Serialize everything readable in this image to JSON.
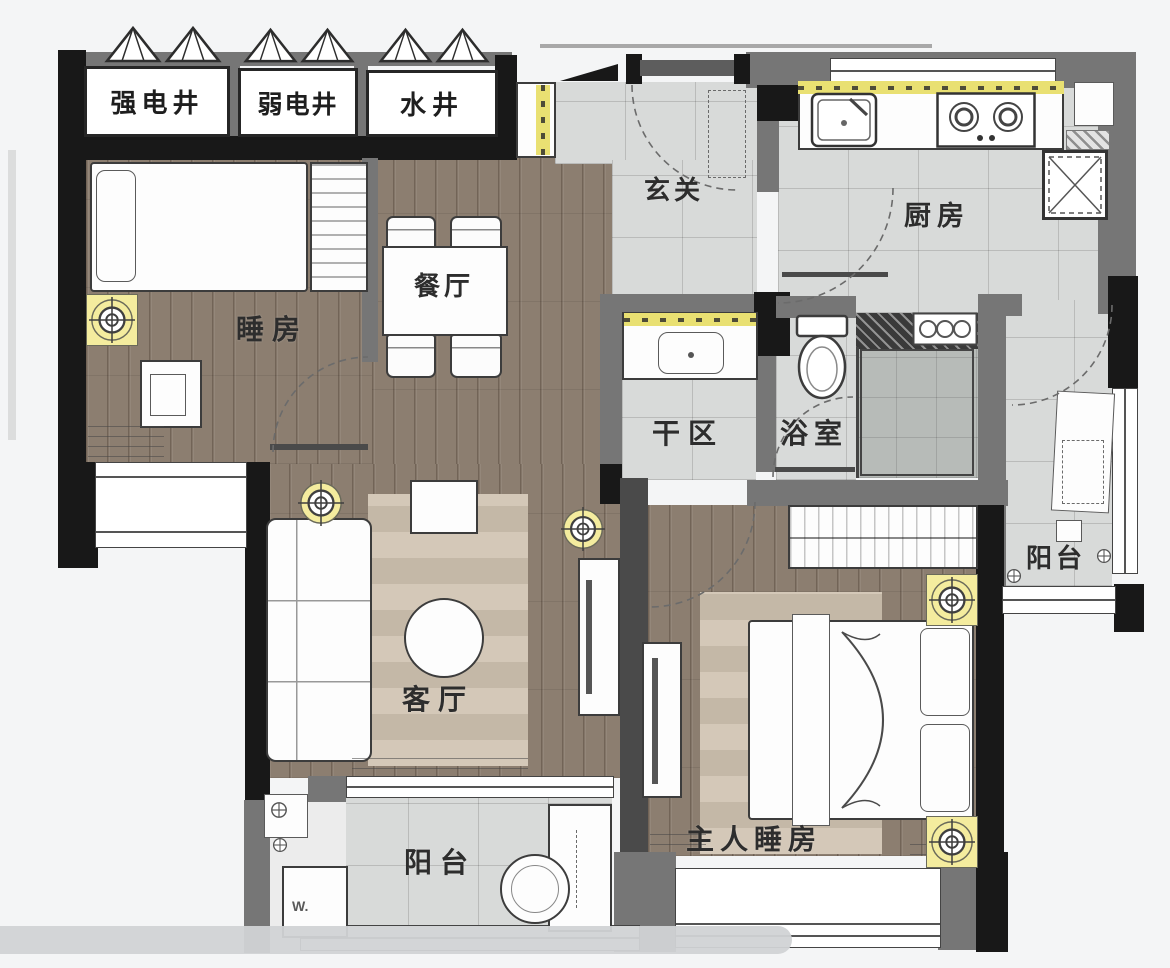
{
  "plan": {
    "rooms": {
      "strong_electric_shaft": "强电井",
      "weak_electric_shaft": "弱电井",
      "water_shaft": "水井",
      "hallway": "玄关",
      "kitchen": "厨房",
      "bedroom": "睡房",
      "dining_room": "餐厅",
      "dry_area": "干区",
      "bathroom": "浴室",
      "balcony_east": "阳台",
      "living_room": "客厅",
      "master_bedroom": "主人睡房",
      "balcony_south": "阳台"
    },
    "appliances": {
      "washing_machine": "W."
    },
    "icons": {
      "ceiling_light": "concentric-target-circle",
      "shaft_vent": "double-triangle-outline",
      "door_swing": "dashed-quarter-arc",
      "floor_drain": "circle-cross",
      "fridge": "crossed-box",
      "stove": "double-burner",
      "toilet": "tank-and-bowl"
    },
    "colors": {
      "wood_floor": "#8c7e70",
      "tile_floor": "#d8dad9",
      "shower_floor": "#b7bbb8",
      "wall_black": "#181818",
      "wall_gray": "#767676",
      "cabinet_yellow": "#e9e072",
      "light_yellow": "#f4ec9e",
      "rug_beige": "#cfc2b0"
    }
  }
}
